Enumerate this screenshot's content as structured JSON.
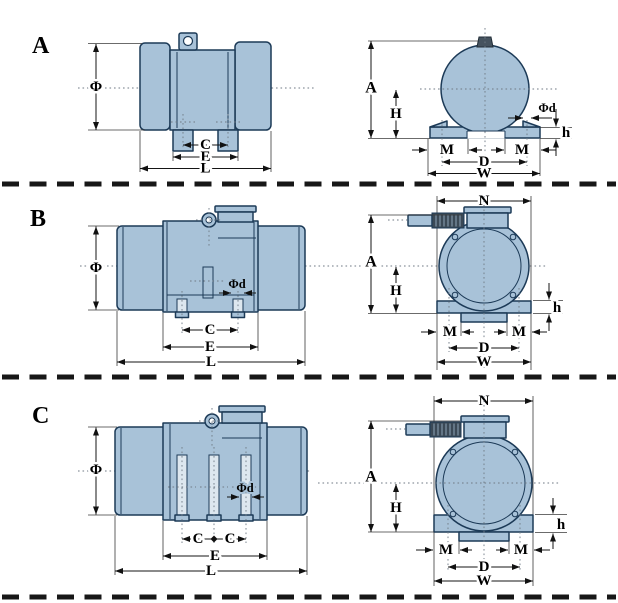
{
  "title": "Vibration motor mounting dimension diagrams",
  "colors": {
    "body": "#a8c2d8",
    "body_light": "#dde7ef",
    "outline": "#1c3a57",
    "dark_cap": "#46535f",
    "dim_line": "#151515",
    "separator": "#171717",
    "background": "#ffffff"
  },
  "labels": {
    "phi": "Φ",
    "phid": "Φd",
    "a": "A",
    "c": "C",
    "e": "E",
    "l": "L",
    "h_upper": "H",
    "h_lower": "h",
    "m": "M",
    "d": "D",
    "w": "W",
    "n": "N"
  },
  "sections": [
    {
      "letter": "A",
      "views": [
        "side",
        "front"
      ],
      "side_dimensions": [
        "Φ",
        "C",
        "E",
        "L"
      ],
      "front_dimensions": [
        "A",
        "H",
        "Φd",
        "h",
        "M",
        "D",
        "W"
      ]
    },
    {
      "letter": "B",
      "views": [
        "side",
        "front"
      ],
      "side_dimensions": [
        "Φ",
        "Φd",
        "C",
        "E",
        "L"
      ],
      "front_dimensions": [
        "N",
        "A",
        "H",
        "h",
        "M",
        "D",
        "W"
      ]
    },
    {
      "letter": "C",
      "views": [
        "side",
        "front"
      ],
      "side_dimensions": [
        "Φ",
        "Φd",
        "C",
        "C",
        "E",
        "L"
      ],
      "front_dimensions": [
        "N",
        "A",
        "H",
        "h",
        "M",
        "D",
        "W"
      ]
    }
  ]
}
